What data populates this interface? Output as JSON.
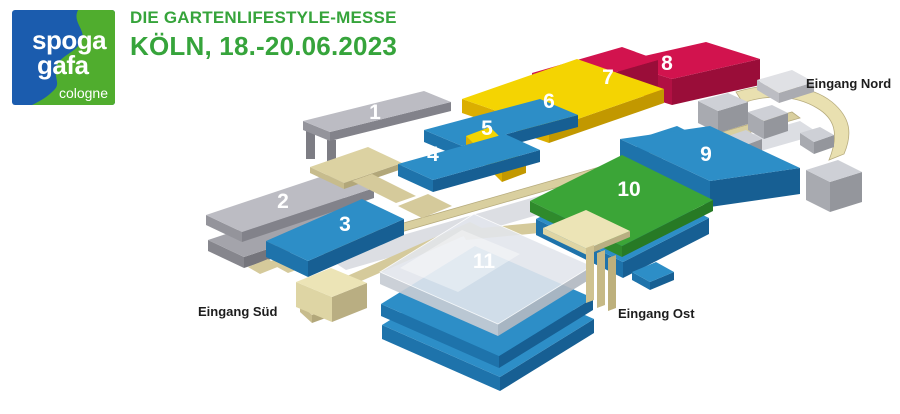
{
  "header": {
    "logo": {
      "line1": "spoga",
      "line2": "gafa",
      "city": "cologne",
      "bg_color": "#1b5cae",
      "bg_style": "background:#1b5cae",
      "wave_color": "#50ad2e"
    },
    "subtitle": "DIE GARTENLIFESTYLE-MESSE",
    "title": "KÖLN, 18.-20.06.2023",
    "text_color": "#36a43b",
    "text_style": "color:#36a43b"
  },
  "map": {
    "background": "#ffffff",
    "palettes": {
      "blue": {
        "top": "#2d8ec7",
        "left": "#1e73ab",
        "right": "#175f93"
      },
      "green": {
        "top": "#3ba537",
        "left": "#2f8a2c",
        "right": "#277a25"
      },
      "yellow": {
        "top": "#f4d402",
        "left": "#dbae00",
        "right": "#c29800"
      },
      "red": {
        "top": "#d2134e",
        "left": "#b11043",
        "right": "#9a0d39"
      },
      "gray": {
        "top": "#bcbcc3",
        "left": "#94949b",
        "right": "#82828a"
      },
      "graydark": {
        "top": "#a4a4ab",
        "left": "#86868d",
        "right": "#75757c"
      },
      "silver": {
        "top": "#ced0d6",
        "left": "#a8aab0",
        "right": "#94969c"
      },
      "silverlight": {
        "top": "#e0e1e5",
        "left": "#bcbdc3",
        "right": "#aaabb1"
      },
      "beige": {
        "top": "#dcd2a2",
        "left": "#c7bc8d",
        "right": "#b2a77a"
      },
      "beigebright": {
        "top": "#ece4b6",
        "left": "#ded5a4",
        "right": "#b9ae82"
      },
      "glass": {
        "top": "rgba(226,230,236,0.9)",
        "left": "rgba(199,204,212,0.92)",
        "right": "rgba(178,184,193,0.92)",
        "edge": "rgba(255,255,255,0.85)"
      }
    },
    "shapes": [
      {
        "name": "hall-8",
        "kind": "slab",
        "palette": "red",
        "t": 26,
        "interactable": true,
        "quad": [
          [
            618,
            62
          ],
          [
            706,
            42
          ],
          [
            760,
            59
          ],
          [
            672,
            79
          ]
        ]
      },
      {
        "name": "hall-7",
        "kind": "slab",
        "palette": "red",
        "t": 26,
        "interactable": true,
        "quad": [
          [
            532,
            73
          ],
          [
            622,
            47
          ],
          [
            658,
            60
          ],
          [
            568,
            86
          ]
        ]
      },
      {
        "name": "hall-6",
        "kind": "slab",
        "palette": "yellow",
        "t": 14,
        "interactable": true,
        "quad": [
          [
            462,
            99
          ],
          [
            577,
            59
          ],
          [
            664,
            89
          ],
          [
            549,
            129
          ]
        ]
      },
      {
        "name": "north-entrance-canopy",
        "kind": "path",
        "fill": "#e9e0b0",
        "stroke": "#b7ac7e",
        "d": "M736,92 C775,80 812,86 832,102 C850,117 853,133 844,154 L829,160 C840,133 834,118 817,108 C794,94 764,95 743,103 Z"
      },
      {
        "name": "hall-1-leg-a",
        "kind": "flat",
        "fill": "#7d7d84",
        "pts": [
          [
            306,
            128
          ],
          [
            315,
            128
          ],
          [
            315,
            159
          ],
          [
            306,
            159
          ]
        ]
      },
      {
        "name": "hall-1-leg-b",
        "kind": "flat",
        "fill": "#7d7d84",
        "pts": [
          [
            327,
            140
          ],
          [
            336,
            140
          ],
          [
            336,
            167
          ],
          [
            327,
            167
          ]
        ]
      },
      {
        "name": "hall-1",
        "kind": "slab",
        "palette": "gray",
        "t": 9,
        "interactable": true,
        "quad": [
          [
            303,
            121
          ],
          [
            424,
            91
          ],
          [
            451,
            102
          ],
          [
            330,
            132
          ]
        ]
      },
      {
        "name": "hall-5",
        "kind": "slab",
        "palette": "blue",
        "t": 12,
        "interactable": true,
        "quad": [
          [
            424,
            130
          ],
          [
            540,
            99
          ],
          [
            578,
            115
          ],
          [
            462,
            146
          ]
        ]
      },
      {
        "name": "hall-annex-blue",
        "kind": "slab",
        "palette": "blue",
        "t": 9,
        "quad": [
          [
            637,
            139
          ],
          [
            677,
            126
          ],
          [
            699,
            137
          ],
          [
            659,
            150
          ]
        ]
      },
      {
        "name": "hall-annex-yellow",
        "kind": "slab",
        "palette": "yellow",
        "t": 10,
        "quad": [
          [
            466,
            136
          ],
          [
            490,
            127
          ],
          [
            526,
            163
          ],
          [
            502,
            172
          ]
        ]
      },
      {
        "name": "boulevard-glass-roof",
        "kind": "flat",
        "fill": "#dcdee3",
        "pts": [
          [
            326,
            257
          ],
          [
            800,
            121
          ],
          [
            820,
            134
          ],
          [
            346,
            270
          ]
        ]
      },
      {
        "name": "boulevard-walkway",
        "kind": "flat",
        "fill": "#d9cf9f",
        "stroke": "#b6ab7d",
        "pts": [
          [
            316,
            248
          ],
          [
            792,
            112
          ],
          [
            800,
            118
          ],
          [
            324,
            254
          ]
        ]
      },
      {
        "name": "north-cube-a",
        "kind": "slab",
        "palette": "silver",
        "t": 22,
        "quad": [
          [
            698,
            101
          ],
          [
            728,
            93
          ],
          [
            748,
            102
          ],
          [
            718,
            111
          ]
        ]
      },
      {
        "name": "north-cube-b",
        "kind": "slab",
        "palette": "silver",
        "t": 18,
        "quad": [
          [
            748,
            112
          ],
          [
            772,
            105
          ],
          [
            788,
            113
          ],
          [
            764,
            121
          ]
        ]
      },
      {
        "name": "north-cube-c",
        "kind": "slab",
        "palette": "silver",
        "t": 16,
        "quad": [
          [
            722,
            138
          ],
          [
            746,
            130
          ],
          [
            762,
            139
          ],
          [
            738,
            148
          ]
        ]
      },
      {
        "name": "north-slab",
        "kind": "slab",
        "palette": "silverlight",
        "t": 10,
        "quad": [
          [
            757,
            80
          ],
          [
            792,
            70
          ],
          [
            814,
            82
          ],
          [
            779,
            93
          ]
        ]
      },
      {
        "name": "north-cube-d",
        "kind": "slab",
        "palette": "silver",
        "t": 12,
        "quad": [
          [
            800,
            133
          ],
          [
            820,
            127
          ],
          [
            834,
            135
          ],
          [
            814,
            142
          ]
        ]
      },
      {
        "name": "hall-2-base",
        "kind": "slab",
        "palette": "graydark",
        "t": 11,
        "quad": [
          [
            208,
            240
          ],
          [
            340,
            196
          ],
          [
            376,
            213
          ],
          [
            244,
            257
          ]
        ]
      },
      {
        "name": "hall-2",
        "kind": "slab",
        "palette": "gray",
        "t": 10,
        "interactable": true,
        "quad": [
          [
            206,
            215
          ],
          [
            338,
            171
          ],
          [
            374,
            188
          ],
          [
            242,
            232
          ]
        ]
      },
      {
        "name": "walkway-platform",
        "kind": "slab",
        "palette": "beige",
        "t": 6,
        "quad": [
          [
            310,
            167
          ],
          [
            368,
            147
          ],
          [
            402,
            163
          ],
          [
            344,
            183
          ]
        ]
      },
      {
        "name": "walkway-strip-a",
        "kind": "flat",
        "fill": "#d5ca9b",
        "pts": [
          [
            352,
            181
          ],
          [
            372,
            174
          ],
          [
            416,
            196
          ],
          [
            396,
            203
          ]
        ]
      },
      {
        "name": "walkway-strip-b",
        "kind": "flat",
        "fill": "#d5ca9b",
        "pts": [
          [
            398,
            206
          ],
          [
            428,
            194
          ],
          [
            452,
            206
          ],
          [
            422,
            218
          ]
        ]
      },
      {
        "name": "walkway-strip-c",
        "kind": "flat",
        "fill": "#d5ca9b",
        "pts": [
          [
            268,
            262
          ],
          [
            290,
            254
          ],
          [
            310,
            265
          ],
          [
            288,
            273
          ]
        ]
      },
      {
        "name": "south-walkway",
        "kind": "flat",
        "fill": "#d5ca9b",
        "pts": [
          [
            322,
            287
          ],
          [
            470,
            222
          ],
          [
            482,
            228
          ],
          [
            334,
            293
          ]
        ]
      },
      {
        "name": "east-walkway",
        "kind": "flat",
        "fill": "#d5ca9b",
        "pts": [
          [
            460,
            230
          ],
          [
            544,
            222
          ],
          [
            550,
            232
          ],
          [
            466,
            240
          ]
        ]
      },
      {
        "name": "hall-4",
        "kind": "slab",
        "palette": "blue",
        "t": 12,
        "interactable": true,
        "quad": [
          [
            398,
            164
          ],
          [
            505,
            134
          ],
          [
            540,
            150
          ],
          [
            433,
            180
          ]
        ]
      },
      {
        "name": "hall-3",
        "kind": "slab",
        "palette": "blue",
        "t": 16,
        "interactable": true,
        "quad": [
          [
            266,
            241
          ],
          [
            362,
            199
          ],
          [
            404,
            219
          ],
          [
            308,
            261
          ]
        ]
      },
      {
        "name": "hall-9",
        "kind": "slab",
        "palette": "blue",
        "t": 26,
        "interactable": true,
        "quad": [
          [
            620,
            139
          ],
          [
            710,
            126
          ],
          [
            800,
            168
          ],
          [
            710,
            181
          ]
        ]
      },
      {
        "name": "east-cube",
        "kind": "slab",
        "palette": "silver",
        "t": 30,
        "quad": [
          [
            806,
            170
          ],
          [
            838,
            160
          ],
          [
            862,
            172
          ],
          [
            830,
            182
          ]
        ]
      },
      {
        "name": "hall-10-base",
        "kind": "slab",
        "palette": "blue",
        "t": 16,
        "quad": [
          [
            536,
            219
          ],
          [
            622,
            175
          ],
          [
            709,
            218
          ],
          [
            623,
            262
          ]
        ]
      },
      {
        "name": "hall-10",
        "kind": "slab",
        "palette": "green",
        "t": 11,
        "interactable": true,
        "quad": [
          [
            530,
            201
          ],
          [
            622,
            155
          ],
          [
            713,
            200
          ],
          [
            622,
            246
          ]
        ]
      },
      {
        "name": "hall-11-lower",
        "kind": "slab",
        "palette": "blue",
        "t": 14,
        "quad": [
          [
            382,
            325
          ],
          [
            476,
            267
          ],
          [
            594,
            319
          ],
          [
            500,
            377
          ]
        ]
      },
      {
        "name": "hall-11-mid",
        "kind": "slab",
        "palette": "blue",
        "t": 12,
        "quad": [
          [
            381,
            304
          ],
          [
            475,
            246
          ],
          [
            593,
            298
          ],
          [
            499,
            356
          ]
        ]
      },
      {
        "name": "hall-11-glass",
        "kind": "slab",
        "palette": "glass",
        "t": 12,
        "interactable": true,
        "quad": [
          [
            380,
            272
          ],
          [
            474,
            214
          ],
          [
            592,
            266
          ],
          [
            498,
            324
          ]
        ]
      },
      {
        "name": "glass-highlight",
        "kind": "flat",
        "fill": "rgba(255,255,255,0.38)",
        "pts": [
          [
            400,
            268
          ],
          [
            462,
            230
          ],
          [
            520,
            254
          ],
          [
            458,
            292
          ]
        ]
      },
      {
        "name": "east-entrance-roof",
        "kind": "slab",
        "palette": "beigebright",
        "t": 6,
        "quad": [
          [
            543,
            228
          ],
          [
            586,
            210
          ],
          [
            630,
            231
          ],
          [
            587,
            249
          ]
        ]
      },
      {
        "name": "east-column-a",
        "kind": "flat",
        "fill": "#cfc290",
        "pts": [
          [
            586,
            248
          ],
          [
            594,
            245
          ],
          [
            594,
            300
          ],
          [
            586,
            303
          ]
        ]
      },
      {
        "name": "east-column-b",
        "kind": "flat",
        "fill": "#c6b986",
        "pts": [
          [
            597,
            253
          ],
          [
            605,
            250
          ],
          [
            605,
            305
          ],
          [
            597,
            308
          ]
        ]
      },
      {
        "name": "east-column-c",
        "kind": "flat",
        "fill": "#bdb07c",
        "pts": [
          [
            608,
            258
          ],
          [
            616,
            255
          ],
          [
            616,
            308
          ],
          [
            608,
            311
          ]
        ]
      },
      {
        "name": "south-bit-a",
        "kind": "flat",
        "fill": "#d5ca9b",
        "pts": [
          [
            248,
            267
          ],
          [
            268,
            259
          ],
          [
            280,
            266
          ],
          [
            260,
            274
          ]
        ]
      },
      {
        "name": "south-bit-b",
        "kind": "slab",
        "palette": "beige",
        "t": 8,
        "quad": [
          [
            300,
            304
          ],
          [
            322,
            296
          ],
          [
            334,
            307
          ],
          [
            312,
            315
          ]
        ]
      },
      {
        "name": "east-bit-blue",
        "kind": "slab",
        "palette": "blue",
        "t": 8,
        "quad": [
          [
            632,
            272
          ],
          [
            656,
            262
          ],
          [
            674,
            272
          ],
          [
            650,
            282
          ]
        ]
      },
      {
        "name": "south-entrance-cube",
        "kind": "slab",
        "palette": "beigebright",
        "t": 25,
        "quad": [
          [
            296,
            282
          ],
          [
            331,
            268
          ],
          [
            367,
            283
          ],
          [
            332,
            297
          ]
        ]
      }
    ],
    "hall_labels": [
      {
        "text": "1",
        "x": 375,
        "y": 119
      },
      {
        "text": "2",
        "x": 283,
        "y": 208
      },
      {
        "text": "3",
        "x": 345,
        "y": 231
      },
      {
        "text": "4",
        "x": 433,
        "y": 161
      },
      {
        "text": "5",
        "x": 487,
        "y": 135
      },
      {
        "text": "6",
        "x": 549,
        "y": 108
      },
      {
        "text": "7",
        "x": 608,
        "y": 84
      },
      {
        "text": "8",
        "x": 667,
        "y": 70
      },
      {
        "text": "9",
        "x": 706,
        "y": 161
      },
      {
        "text": "10",
        "x": 629,
        "y": 196
      },
      {
        "text": "11",
        "x": 484,
        "y": 268
      }
    ],
    "entrances": [
      {
        "id": "nord",
        "label": "Eingang Nord",
        "x": 806,
        "y": 88
      },
      {
        "id": "sued",
        "label": "Eingang Süd",
        "x": 198,
        "y": 316
      },
      {
        "id": "ost",
        "label": "Eingang Ost",
        "x": 618,
        "y": 318
      }
    ]
  }
}
